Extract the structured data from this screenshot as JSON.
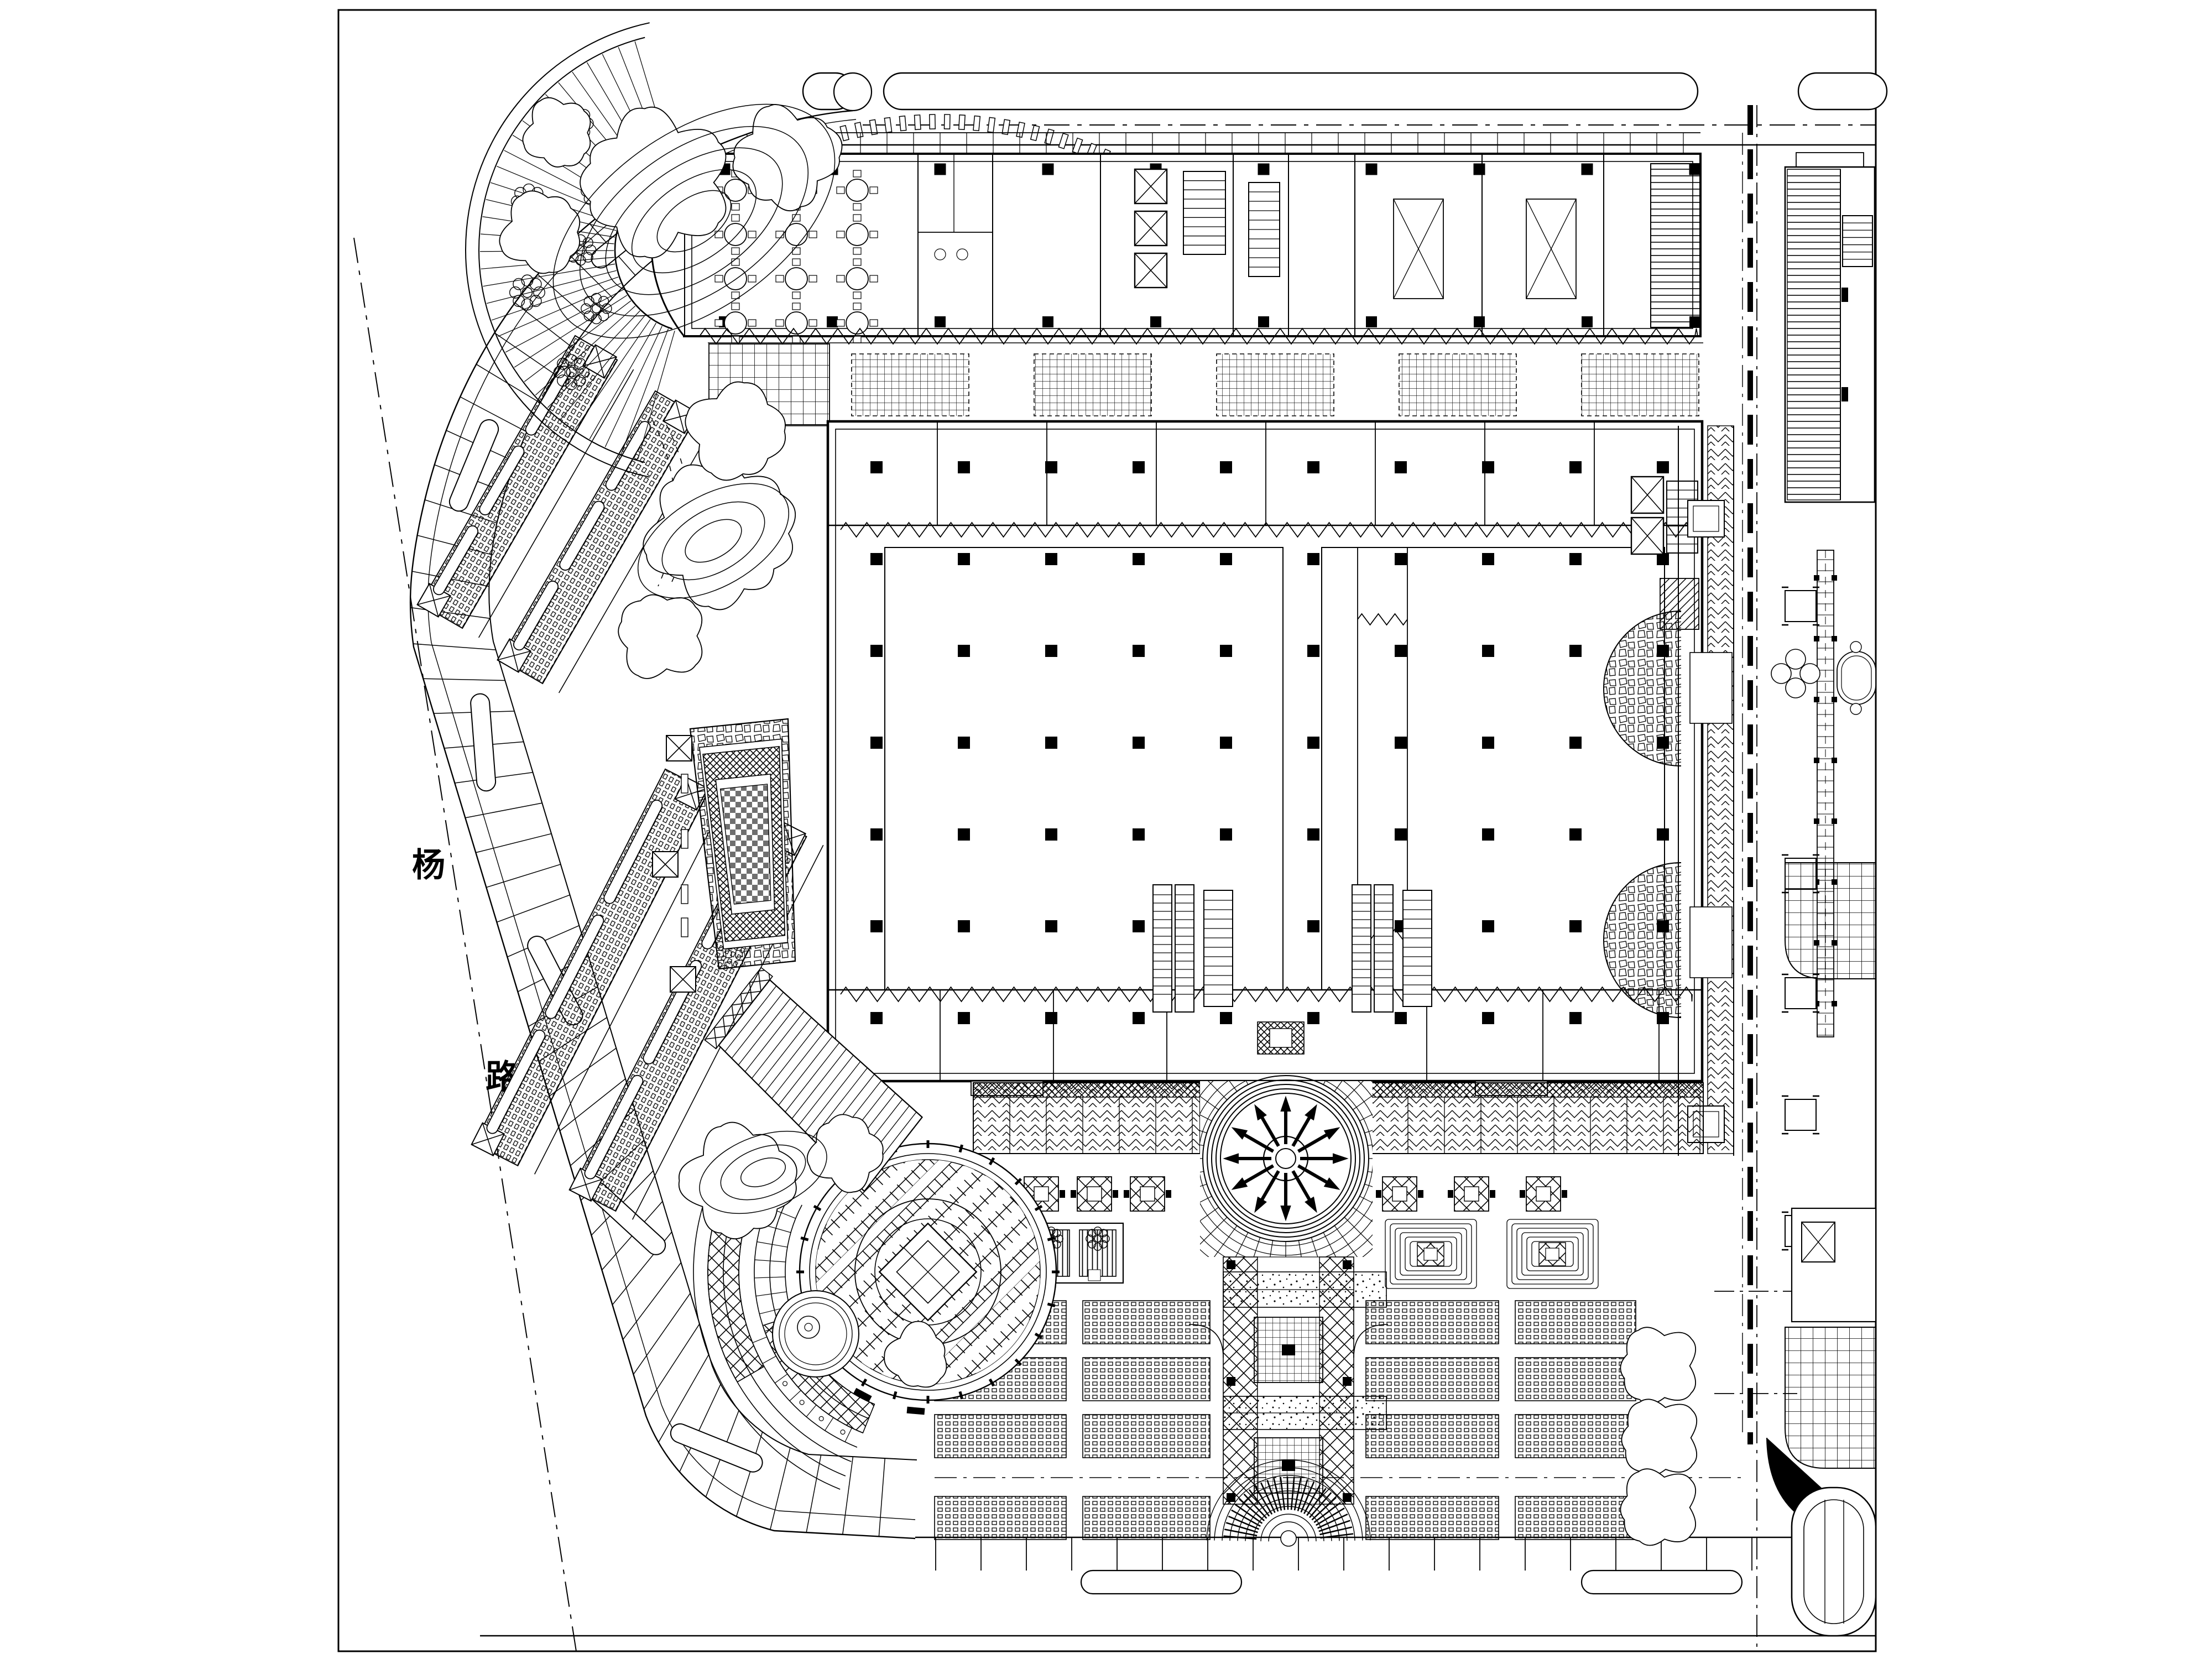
{
  "sheet": {
    "background": "#ffffff",
    "line_color": "#000000",
    "frame_color": "#000000"
  },
  "watermark": {
    "line1": "TZ素材网",
    "line2": "TZSUCAI.COM",
    "color": "#a0a0a0",
    "opacity": 0.5
  },
  "road_labels": {
    "west_top": "杨",
    "west_bottom": "路"
  },
  "features": {
    "north_building": "restaurant-and-tower-floor-plan",
    "main_block": "shopping-mall-column-grid-block",
    "fan_plaza": "radial-fan-entry-plaza",
    "sunburst": "compass-star-paving-circle",
    "sw_plaza": "circular-diamond-plaza",
    "axis_walk": "south-axis-walkway",
    "parking": "surface-parking-rows",
    "east_strip": "street-side-garden-strip"
  }
}
